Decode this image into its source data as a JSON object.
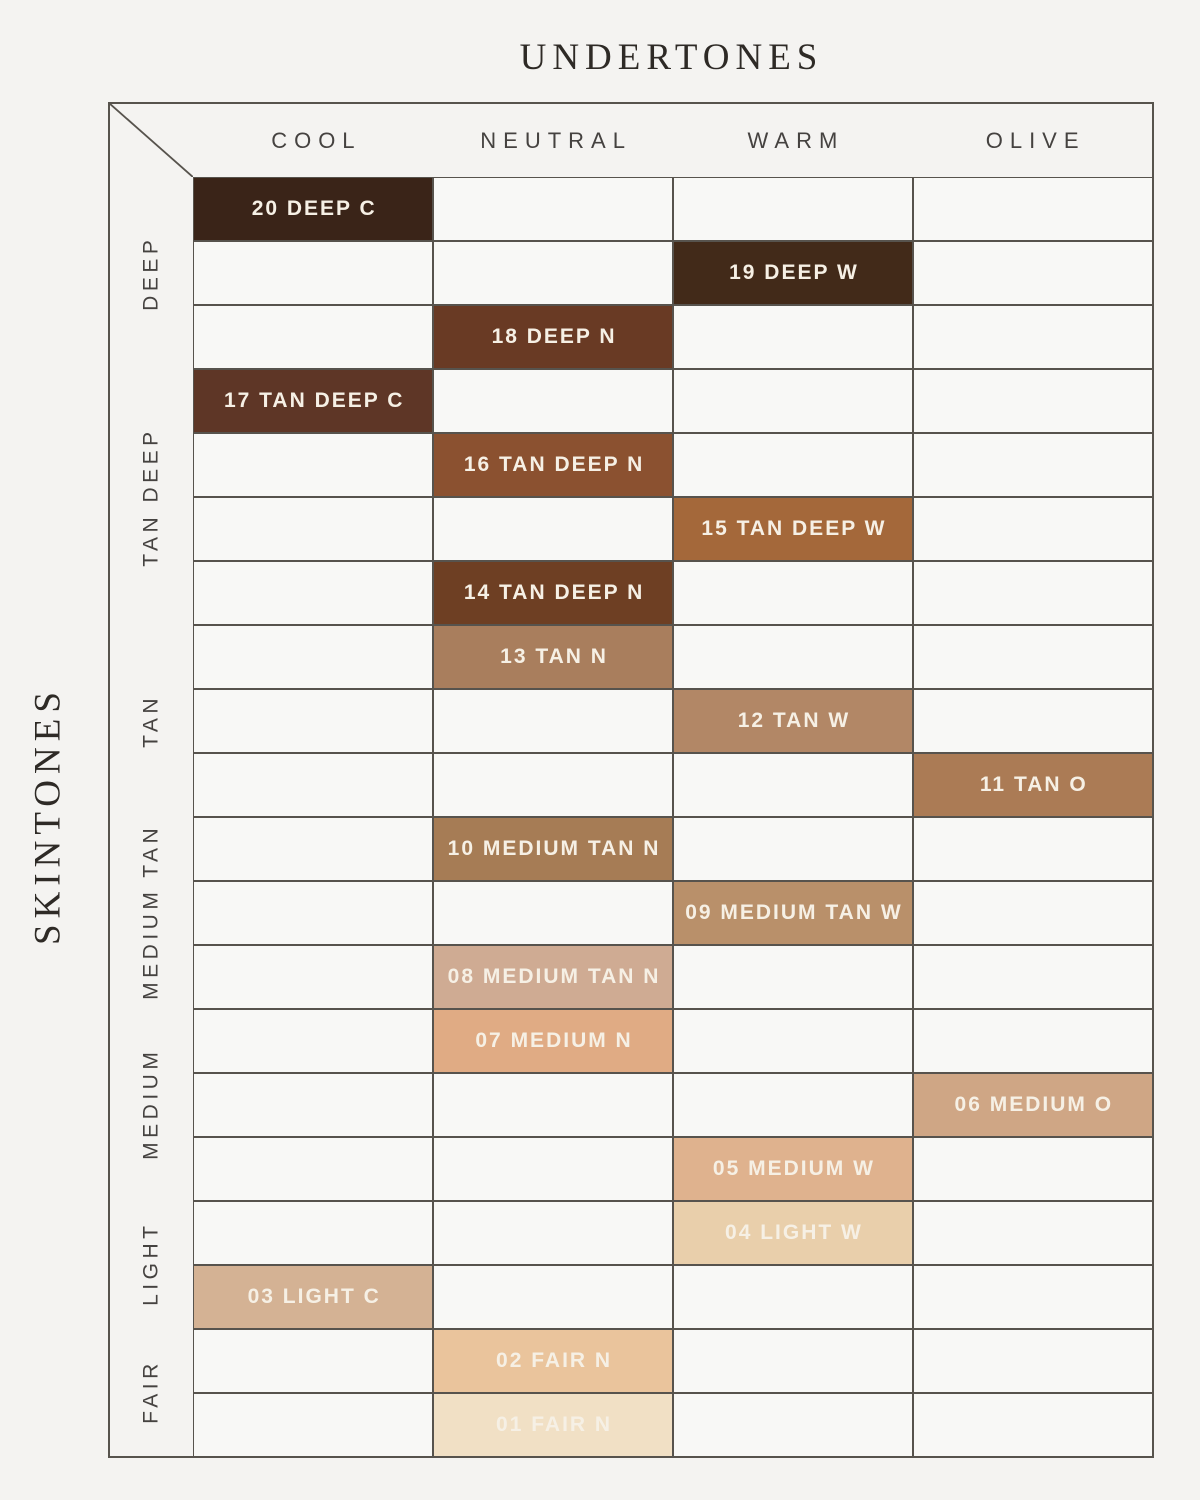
{
  "title": "UNDERTONES",
  "side_title": "SKINTONES",
  "colors": {
    "page_background": "#f4f3f1",
    "cell_background": "#f8f8f6",
    "grid_line": "#57534d",
    "heading_text": "#2e2a26",
    "label_text": "#454240",
    "swatch_label_text": "#f6f0e5"
  },
  "skintone_groups": [
    {
      "label": "DEEP",
      "rows": 3
    },
    {
      "label": "TAN DEEP",
      "rows": 4
    },
    {
      "label": "TAN",
      "rows": 3
    },
    {
      "label": "MEDIUM TAN",
      "rows": 3
    },
    {
      "label": "MEDIUM",
      "rows": 3
    },
    {
      "label": "LIGHT",
      "rows": 2
    },
    {
      "label": "FAIR",
      "rows": 2
    }
  ],
  "chart_data": {
    "type": "table",
    "title": "UNDERTONES",
    "xlabel": "UNDERTONES",
    "ylabel": "SKINTONES",
    "columns": [
      "COOL",
      "NEUTRAL",
      "WARM",
      "OLIVE"
    ],
    "rows": [
      {
        "label": "20 DEEP C",
        "undertone": "COOL",
        "skintone_group": "DEEP",
        "swatch_color": "#3a2418"
      },
      {
        "label": "19 DEEP W",
        "undertone": "WARM",
        "skintone_group": "DEEP",
        "swatch_color": "#422a19"
      },
      {
        "label": "18 DEEP N",
        "undertone": "NEUTRAL",
        "skintone_group": "DEEP",
        "swatch_color": "#693a24"
      },
      {
        "label": "17 TAN DEEP C",
        "undertone": "COOL",
        "skintone_group": "TAN DEEP",
        "swatch_color": "#5e3626"
      },
      {
        "label": "16 TAN DEEP N",
        "undertone": "NEUTRAL",
        "skintone_group": "TAN DEEP",
        "swatch_color": "#8b5130"
      },
      {
        "label": "15 TAN DEEP W",
        "undertone": "WARM",
        "skintone_group": "TAN DEEP",
        "swatch_color": "#a4683a"
      },
      {
        "label": "14 TAN DEEP N",
        "undertone": "NEUTRAL",
        "skintone_group": "TAN DEEP",
        "swatch_color": "#6e3f23"
      },
      {
        "label": "13 TAN N",
        "undertone": "NEUTRAL",
        "skintone_group": "TAN",
        "swatch_color": "#a97e5d"
      },
      {
        "label": "12 TAN W",
        "undertone": "WARM",
        "skintone_group": "TAN",
        "swatch_color": "#b28766"
      },
      {
        "label": "11 TAN O",
        "undertone": "OLIVE",
        "skintone_group": "TAN",
        "swatch_color": "#ab7b55"
      },
      {
        "label": "10 MEDIUM TAN N",
        "undertone": "NEUTRAL",
        "skintone_group": "MEDIUM TAN",
        "swatch_color": "#a67c55"
      },
      {
        "label": "09 MEDIUM TAN W",
        "undertone": "WARM",
        "skintone_group": "MEDIUM TAN",
        "swatch_color": "#b9906a"
      },
      {
        "label": "08 MEDIUM TAN N",
        "undertone": "NEUTRAL",
        "skintone_group": "MEDIUM TAN",
        "swatch_color": "#cfab93"
      },
      {
        "label": "07 MEDIUM N",
        "undertone": "NEUTRAL",
        "skintone_group": "MEDIUM",
        "swatch_color": "#e0ab84"
      },
      {
        "label": "06 MEDIUM O",
        "undertone": "OLIVE",
        "skintone_group": "MEDIUM",
        "swatch_color": "#cfa685"
      },
      {
        "label": "05 MEDIUM W",
        "undertone": "WARM",
        "skintone_group": "MEDIUM",
        "swatch_color": "#dfb28e"
      },
      {
        "label": "04 LIGHT W",
        "undertone": "WARM",
        "skintone_group": "LIGHT",
        "swatch_color": "#e9cfab"
      },
      {
        "label": "03 LIGHT C",
        "undertone": "COOL",
        "skintone_group": "LIGHT",
        "swatch_color": "#d4b294"
      },
      {
        "label": "02 FAIR N",
        "undertone": "NEUTRAL",
        "skintone_group": "FAIR",
        "swatch_color": "#eac49c"
      },
      {
        "label": "01 FAIR N",
        "undertone": "NEUTRAL",
        "skintone_group": "FAIR",
        "swatch_color": "#f1e0c5"
      }
    ]
  }
}
